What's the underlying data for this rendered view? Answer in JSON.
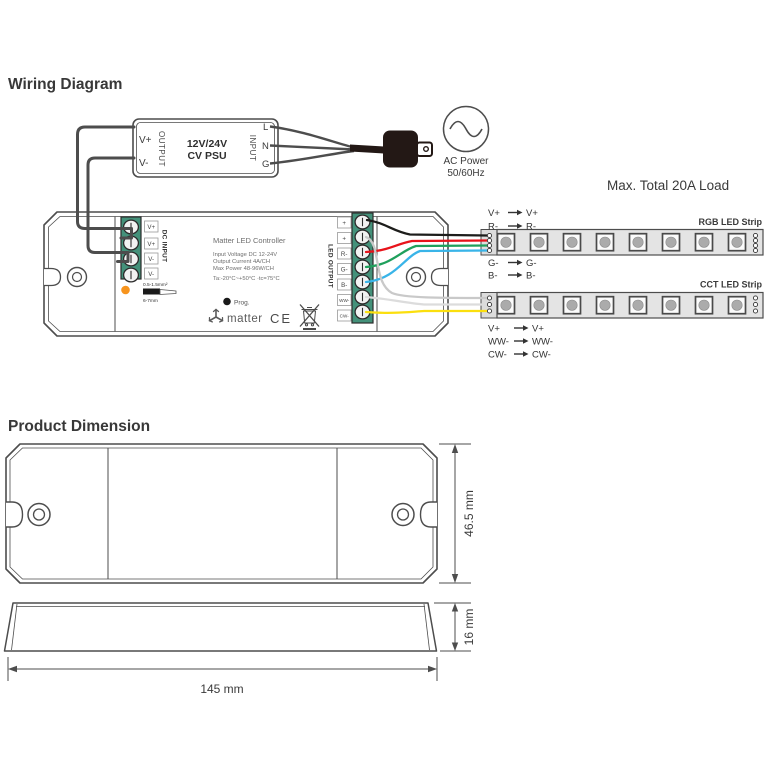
{
  "sections": {
    "wiring_title": "Wiring Diagram",
    "dimension_title": "Product Dimension"
  },
  "psu": {
    "out_pos": "V+",
    "out_neg": "V-",
    "output_label": "OUTPUT",
    "model_line1": "12V/24V",
    "model_line2": "CV PSU",
    "input_label": "INPUT",
    "line": "L",
    "neutral": "N",
    "ground": "G"
  },
  "ac": {
    "label_line1": "AC Power",
    "label_line2": "50/60Hz"
  },
  "load_note": "Max. Total 20A Load",
  "controller": {
    "title": "Matter LED Controller",
    "spec_voltage": "Input Voltage DC 12-24V",
    "spec_current": "Output Current 4A/CH",
    "spec_power": "Max Power 48-96W/CH",
    "spec_temp": "Ta:-20°C~+50°C   ·tc=75°C",
    "prog_label": "Prog.",
    "brand": "matter",
    "ce_mark": "CE",
    "dc_input_label": "DC INPUT",
    "dc_terminals": [
      "V+",
      "V+",
      "V-",
      "V-"
    ],
    "led_output_label": "LED OUTPUT",
    "led_terminals": [
      "+",
      "+",
      "R-",
      "G-",
      "B-",
      "WW-",
      "CW-"
    ],
    "wire_gauge": "0.5-1.5mm²",
    "strip_length": "6-7mm"
  },
  "rgb_strip": {
    "title": "RGB LED Strip",
    "above": [
      [
        "V+",
        "V+"
      ],
      [
        "R-",
        "R-"
      ]
    ],
    "below": [
      [
        "G-",
        "G-"
      ],
      [
        "B-",
        "B-"
      ]
    ]
  },
  "cct_strip": {
    "title": "CCT LED Strip",
    "below": [
      [
        "V+",
        "V+"
      ],
      [
        "WW-",
        "WW-"
      ],
      [
        "CW-",
        "CW-"
      ]
    ]
  },
  "dimensions": {
    "height": "46.5 mm",
    "thickness": "16 mm",
    "length": "145 mm"
  },
  "colors": {
    "wire_red": "#e8131b",
    "wire_negative": "#b3b3b3",
    "wire_green": "#1fa05c",
    "wire_blue": "#39b4e8",
    "wire_white": "#dcdcdc",
    "wire_yellow": "#fbdf0e",
    "wire_gray": "#c9c9c9",
    "wire_black": "#1d1d1b",
    "terminal_green": "#44917a",
    "status_led": "#f7941d",
    "plug_black": "#231815"
  }
}
